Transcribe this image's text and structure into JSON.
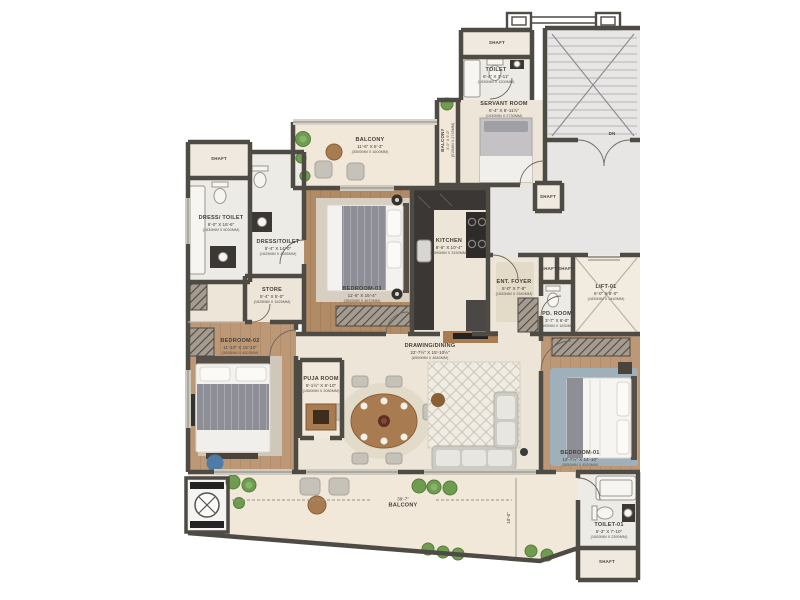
{
  "colors": {
    "wall": "#4e4a44",
    "floor_cream": "#ece5d8",
    "floor_wood": "#b3906e",
    "floor_bath": "#edebe6",
    "floor_corridor": "#e7e6e5",
    "floor_balcony": "#f1e8da",
    "plant_green": "#6f9c50",
    "accent_blue": "#4f7ba8",
    "marble_dark": "#3a3734",
    "label_text": "#45403a"
  },
  "rooms": {
    "shaft_top": {
      "name": "SHAFT"
    },
    "toilet_top": {
      "name": "TOILET",
      "dims": "6'-4\" X 3'-11\"",
      "mm": "(1930MM X 1200MM)"
    },
    "servant_room": {
      "name": "SERVANT ROOM",
      "dims": "6'-4\" X 8'-11½\"",
      "mm": "(1930MM X 2730MM)"
    },
    "balcony_servant": {
      "name": "BALCONY",
      "dims": "3'-0\" X 9'-0\"",
      "mm": "(915MM X 2745MM)"
    },
    "staircase": {
      "dn": "DN"
    },
    "corridor": {
      "name": "CORRIDOR",
      "dims": "31'-9\" X 3'-11\"",
      "mm": "(9680MM X 1200MM)"
    },
    "shaft_mid": {
      "name": "SHAFT"
    },
    "lift": {
      "name": "LIFT-01",
      "dims": "6'-0\" X 8'-0\"",
      "mm": "(1830MM X 2440MM)"
    },
    "shaft_a": {
      "name": "SHAFT"
    },
    "shaft_b": {
      "name": "SHAFT"
    },
    "pd_room": {
      "name": "PD. ROOM",
      "dims": "3'-7\" X 6'-0\"",
      "mm": "(1090MM X 1830MM)"
    },
    "ent_foyer": {
      "name": "ENT. FOYER",
      "dims": "5'-0\" X 7'-8\"",
      "mm": "(1520MM X 2340MM)"
    },
    "kitchen": {
      "name": "KITCHEN",
      "dims": "8'-6\" X 10'-4\"",
      "mm": "(2590MM X 3150MM)"
    },
    "bedroom_03": {
      "name": "BEDROOM-03",
      "dims": "11'-6\" X 15'-4\"",
      "mm": "(3500MM X 4670MM)"
    },
    "balcony_top": {
      "name": "BALCONY",
      "dims": "11'-6\" X 5'-3\"",
      "mm": "(3500MM X 1600MM)"
    },
    "shaft_left": {
      "name": "SHAFT"
    },
    "dress_toilet_1": {
      "name": "DRESS/ TOILET",
      "dims": "6'-0\" X 16'-6\"",
      "mm": "(1830MM X 5030MM)"
    },
    "dress_toilet_2": {
      "name": "DRESS/TOILET",
      "dims": "5'-4\" X 14'-0\"",
      "mm": "(1625MM X 4265MM)"
    },
    "store": {
      "name": "STORE",
      "dims": "5'-4\" X 5'-0\"",
      "mm": "(1625MM X 1525MM)"
    },
    "bedroom_02": {
      "name": "BEDROOM-02",
      "dims": "11'-10\" X 15'-10\"",
      "mm": "(3600MM X 4825MM)"
    },
    "puja_room": {
      "name": "PUJA ROOM",
      "dims": "5'-1½\" X 6'-10\"",
      "mm": "(1560MM X 2080MM)"
    },
    "drawing_dining": {
      "name": "DRAWING/DINING",
      "dims": "22'-7½\" X 15'-10½\"",
      "mm": "(6900MM X 4840MM)"
    },
    "bedroom_01": {
      "name": "BEDROOM-01",
      "dims": "12'-7½\" X 14'-10\"",
      "mm": "(3850MM X 4520MM)"
    },
    "toilet_01": {
      "name": "TOILET-01",
      "dims": "5'-3\" X 7'-10\"",
      "mm": "(1600MM X 2390MM)"
    },
    "shaft_bottom": {
      "name": "SHAFT"
    },
    "balcony_bottom": {
      "name": "BALCONY",
      "dims": "39'-7\""
    },
    "dim_vertical": {
      "value": "10'-0\""
    }
  }
}
